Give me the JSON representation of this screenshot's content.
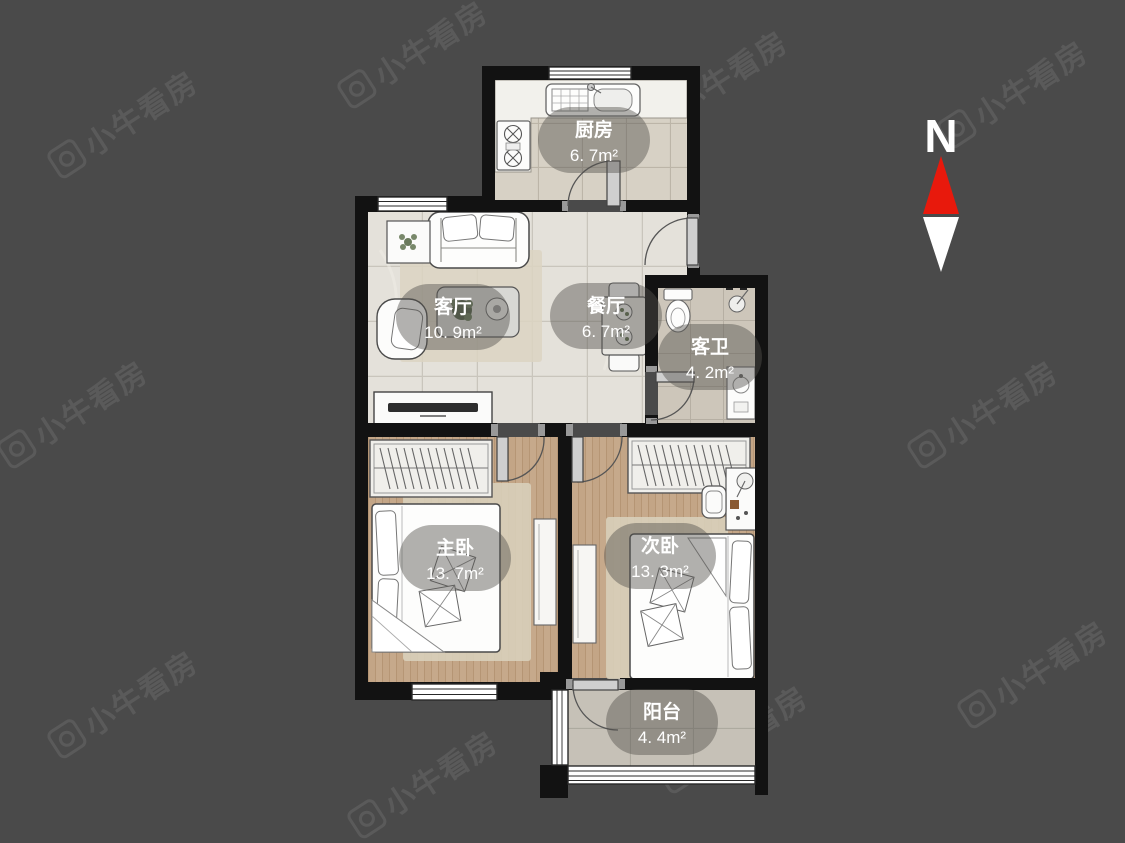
{
  "watermark": {
    "text": "小牛看房"
  },
  "compass": {
    "label": "N"
  },
  "rooms": [
    {
      "name": "厨房",
      "area": "6. 7m²"
    },
    {
      "name": "客厅",
      "area": "10. 9m²"
    },
    {
      "name": "餐厅",
      "area": "6. 7m²"
    },
    {
      "name": "客卫",
      "area": "4. 2m²"
    },
    {
      "name": "主卧",
      "area": "13. 7m²"
    },
    {
      "name": "次卧",
      "area": "13. 3m²"
    },
    {
      "name": "阳台",
      "area": "4. 4m²"
    }
  ],
  "colors": {
    "background": "#4a4a4a",
    "wall": "#121212",
    "compass_north": "#e8190c",
    "floor_wood": "#c6a98b",
    "floor_marble": "#e4e1da",
    "floor_tile_kitchen": "#d7d1c5",
    "floor_tile_bath": "#cdc6ba",
    "floor_tile_balcony": "#c6c1b7",
    "label_text": "#ffffff"
  }
}
